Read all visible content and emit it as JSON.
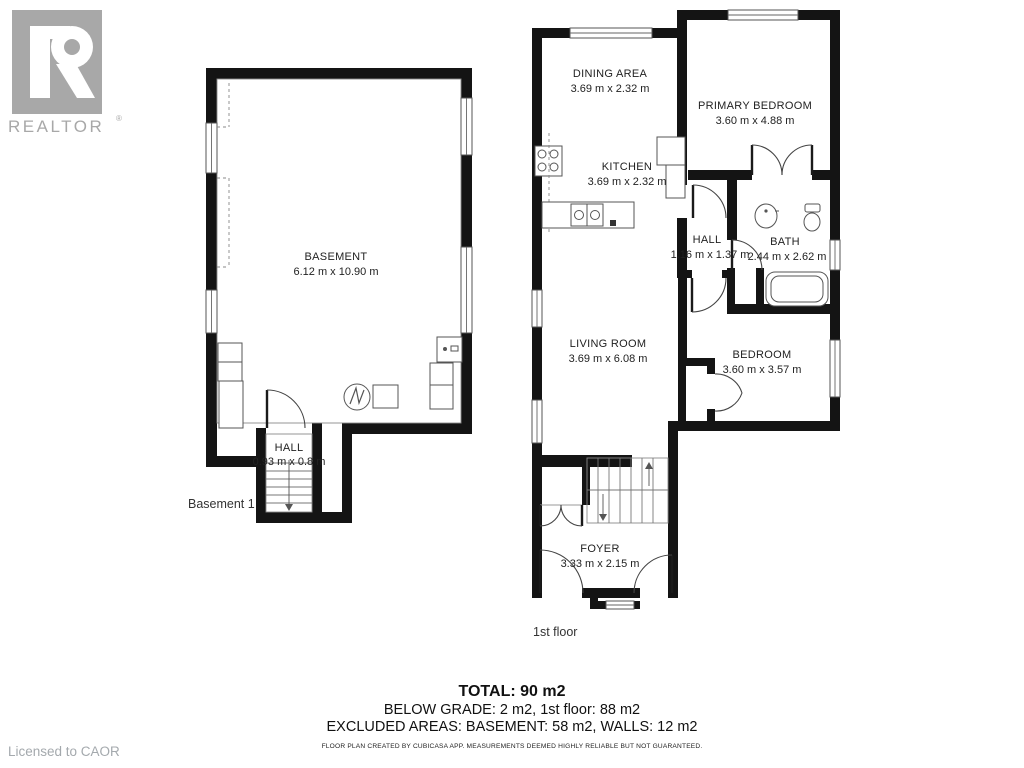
{
  "branding": {
    "logo_letter": "R",
    "wordmark": "REALTOR",
    "registered": "®",
    "licensed_to": "Licensed to CAOR",
    "logo_gray": "#a8a8a8"
  },
  "floors": [
    {
      "label": "Basement 1",
      "rooms": [
        {
          "name": "BASEMENT",
          "dimensions": "6.12 m x 10.90 m"
        },
        {
          "name": "HALL",
          "dimensions": "0.93 m x 0.8 m"
        }
      ]
    },
    {
      "label": "1st floor",
      "rooms": [
        {
          "name": "DINING AREA",
          "dimensions": "3.69 m x 2.32 m"
        },
        {
          "name": "PRIMARY BEDROOM",
          "dimensions": "3.60 m x 4.88 m"
        },
        {
          "name": "KITCHEN",
          "dimensions": "3.69 m x 2.32 m"
        },
        {
          "name": "HALL",
          "dimensions": "1.16 m x 1.37 m"
        },
        {
          "name": "BATH",
          "dimensions": "2.44 m x 2.62 m"
        },
        {
          "name": "LIVING ROOM",
          "dimensions": "3.69 m x 6.08 m"
        },
        {
          "name": "BEDROOM",
          "dimensions": "3.60 m x 3.57 m"
        },
        {
          "name": "FOYER",
          "dimensions": "3.33 m x 2.15 m"
        }
      ]
    }
  ],
  "summary": {
    "total": "TOTAL: 90 m2",
    "below_grade": "BELOW GRADE: 2 m2, 1st floor: 88 m2",
    "excluded": "EXCLUDED AREAS: BASEMENT: 58 m2, WALLS: 12 m2",
    "disclaimer": "FLOOR PLAN CREATED BY CUBICASA APP. MEASUREMENTS DEEMED HIGHLY RELIABLE BUT NOT GUARANTEED."
  },
  "colors": {
    "wall": "#141414",
    "logo_gray": "#a8a8a8",
    "muted_text": "#a4a9ad"
  }
}
